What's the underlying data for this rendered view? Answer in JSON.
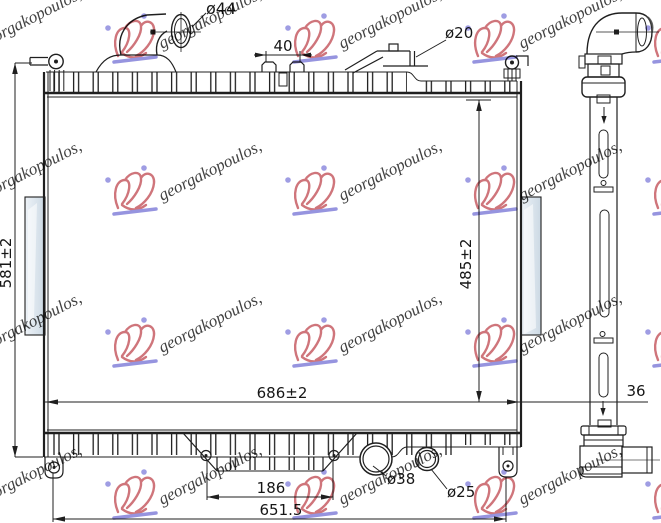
{
  "watermark": {
    "text": "georgakopoulos,",
    "text_color": "#a09ddd",
    "logo_color": "#c4565e",
    "accent_color": "#7f7cd8",
    "positions": [
      [
        -70,
        16
      ],
      [
        110,
        16
      ],
      [
        290,
        16
      ],
      [
        470,
        16
      ],
      [
        650,
        16
      ],
      [
        -70,
        168
      ],
      [
        110,
        168
      ],
      [
        290,
        168
      ],
      [
        470,
        168
      ],
      [
        650,
        168
      ],
      [
        -70,
        320
      ],
      [
        110,
        320
      ],
      [
        290,
        320
      ],
      [
        470,
        320
      ],
      [
        650,
        320
      ],
      [
        -70,
        472
      ],
      [
        110,
        472
      ],
      [
        290,
        472
      ],
      [
        470,
        472
      ],
      [
        650,
        472
      ]
    ]
  },
  "dimensions": {
    "inlet_pipe_diameter": "ø44",
    "filler_tab_spacing": "40",
    "small_pipe_diameter": "ø20",
    "overall_height": "581±2",
    "core_height": "485±2",
    "overall_width": "686±2",
    "bottom_bracket_spacing": "186",
    "mounting_width": "651.5",
    "drain_plug_diameter": "ø38",
    "outlet_diameter": "ø25",
    "core_thickness": "36"
  },
  "colors": {
    "line": "#1f1f1f",
    "bracket_fill_light": "#eef3f8",
    "bracket_fill_dark": "#ccd9e4",
    "slot_blue": "#cfdce9",
    "slot_pink": "#e8c6c8"
  }
}
